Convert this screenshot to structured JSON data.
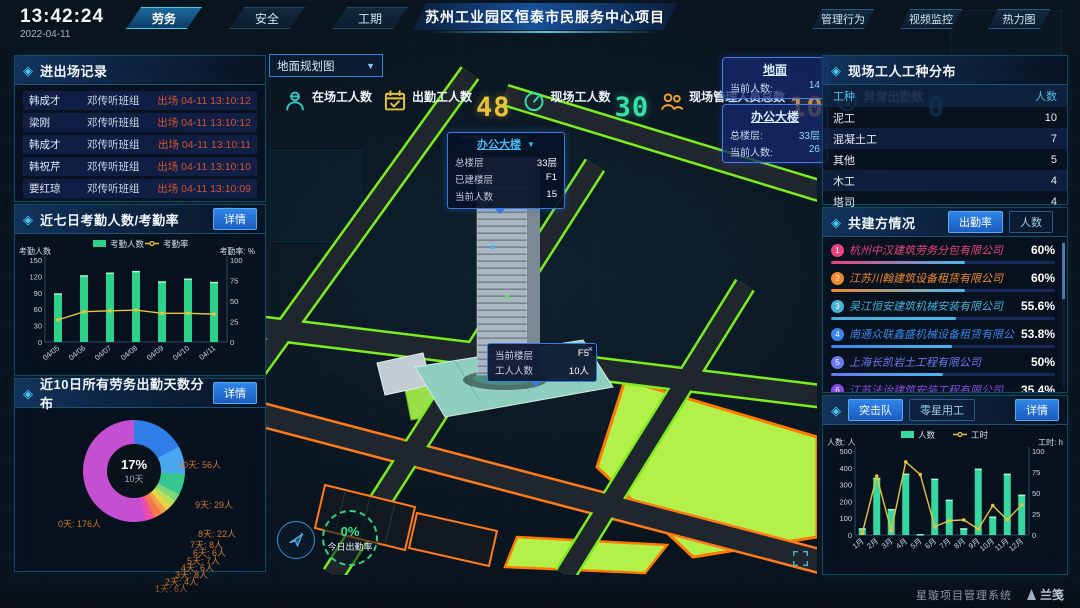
{
  "topbar": {
    "time": "13:42:24",
    "date": "2022-04-11",
    "tabs_left": [
      "劳务",
      "安全",
      "工期"
    ],
    "active_tab_left": "劳务",
    "title": "苏州工业园区恒泰市民服务中心项目",
    "tabs_right": [
      "管理行为",
      "视频监控",
      "热力图"
    ]
  },
  "entry_exit": {
    "title": "进出场记录",
    "more_label": "更多>>",
    "rows": [
      {
        "name": "韩成才",
        "group": "邓传听班组",
        "event": "出场 04-11 13:10:12"
      },
      {
        "name": "梁刚",
        "group": "邓传听班组",
        "event": "出场 04-11 13:10:12"
      },
      {
        "name": "韩成才",
        "group": "邓传听班组",
        "event": "出场 04-11 13:10:11"
      },
      {
        "name": "韩祝芹",
        "group": "邓传听班组",
        "event": "出场 04-11 13:10:10"
      },
      {
        "name": "要红琼",
        "group": "邓传听班组",
        "event": "出场 04-11 13:10:09"
      }
    ]
  },
  "attendance_panel": {
    "title": "近七日考勤人数/考勤率",
    "detail_label": "详情"
  },
  "distribution_panel": {
    "title": "近10日所有劳务出勤天数分布",
    "detail_label": "详情"
  },
  "center": {
    "map_select": "地面规划图",
    "stats": [
      {
        "label": "在场工人数",
        "value": "",
        "color": "#2ec8c0",
        "icon": "worker-icon"
      },
      {
        "label": "出勤工人数",
        "value": "48",
        "color": "#e8c33a",
        "icon": "calendar-check-icon"
      },
      {
        "label": "现场工人数",
        "value": "30",
        "color": "#35e0a8",
        "icon": "gauge-icon"
      },
      {
        "label": "现场管理人员总数",
        "value": "10",
        "color": "#f0a030",
        "icon": "people-icon"
      },
      {
        "label": "异常出勤数",
        "value": "0",
        "color": "#35a0f0",
        "icon": "pulse-icon"
      }
    ],
    "building_tooltip": {
      "title": "办公大楼",
      "rows": [
        [
          "总楼层",
          "33层"
        ],
        [
          "已建楼层",
          "F1"
        ],
        [
          "当前人数",
          "15"
        ]
      ]
    },
    "floor_tooltip": {
      "close": "×",
      "rows": [
        [
          "当前楼层",
          "F5"
        ],
        [
          "工人人数",
          "10人"
        ]
      ]
    },
    "ground_box": {
      "title": "地面",
      "rows": [
        [
          "当前人数:",
          "14"
        ]
      ]
    },
    "office_box": {
      "title": "办公大楼",
      "rows": [
        [
          "总楼层:",
          "33层"
        ],
        [
          "当前人数:",
          "26"
        ]
      ]
    },
    "gauge": {
      "value": "0%",
      "label": "今日出勤率"
    }
  },
  "trade_table": {
    "title": "现场工人工种分布",
    "headers": [
      "工种",
      "人数"
    ],
    "rows": [
      [
        "泥工",
        "10"
      ],
      [
        "混凝土工",
        "7"
      ],
      [
        "其他",
        "5"
      ],
      [
        "木工",
        "4"
      ],
      [
        "塔司",
        "4"
      ]
    ]
  },
  "partners": {
    "title": "共建方情况",
    "tabs": [
      "出勤率",
      "人数"
    ],
    "active_tab": "出勤率",
    "items": [
      {
        "rank": "1",
        "name": "杭州中汉建筑劳务分包有限公司",
        "value": "60%",
        "pct": 60,
        "color": "#e8437e"
      },
      {
        "rank": "2",
        "name": "江苏川翰建筑设备租赁有限公司",
        "value": "60%",
        "pct": 60,
        "color": "#f0882e"
      },
      {
        "rank": "3",
        "name": "吴江恒安建筑机械安装有限公司",
        "value": "55.6%",
        "pct": 55.6,
        "color": "#4ab0d8"
      },
      {
        "rank": "4",
        "name": "南通众联鑫盛机械设备租赁有限公司",
        "value": "53.8%",
        "pct": 53.8,
        "color": "#3a86e8"
      },
      {
        "rank": "5",
        "name": "上海长凯岩土工程有限公司",
        "value": "50%",
        "pct": 50,
        "color": "#6a78f0"
      },
      {
        "rank": "6",
        "name": "江苏法诒建筑安装工程有限公司",
        "value": "35.4%",
        "pct": 35.4,
        "color": "#8a4ae0"
      }
    ]
  },
  "squad_panel": {
    "tabs": [
      "突击队",
      "零星用工"
    ],
    "active_tab": "突击队",
    "detail_label": "详情"
  },
  "footer": {
    "system_name": "星璇项目管理系统",
    "brand": "兰笺"
  },
  "chart_data": [
    {
      "id": "attendance",
      "type": "bar+line",
      "title": "近七日考勤人数/考勤率",
      "categories": [
        "04/05",
        "04/06",
        "04/07",
        "04/08",
        "04/09",
        "04/10",
        "04/11"
      ],
      "series": [
        {
          "name": "考勤人数",
          "type": "bar",
          "color": "#2ed18a",
          "values": [
            89,
            122,
            127,
            130,
            111,
            116,
            110
          ]
        },
        {
          "name": "考勤率",
          "type": "line",
          "color": "#e8c33a",
          "axis": "right",
          "values": [
            27,
            37,
            38,
            39,
            35,
            35,
            34
          ]
        }
      ],
      "left_axis": {
        "label": "考勤人数",
        "min": 0,
        "max": 150,
        "ticks": [
          0,
          30,
          60,
          90,
          120,
          150
        ]
      },
      "right_axis": {
        "label": "考勤率: %",
        "min": 0,
        "max": 100,
        "ticks": [
          0,
          25,
          50,
          75,
          100
        ]
      },
      "legend_position": "top",
      "grid": false
    },
    {
      "id": "distribution",
      "type": "donut",
      "title": "近10日所有劳务出勤天数分布",
      "center": {
        "percent": "17%",
        "label": "10天"
      },
      "slices": [
        {
          "label": "10天",
          "count": 56,
          "text": "10天: 56人",
          "color": "#2f7ee8"
        },
        {
          "label": "9天",
          "count": 29,
          "text": "9天: 29人",
          "color": "#49a6f0"
        },
        {
          "label": "8天",
          "count": 22,
          "text": "8天: 22人",
          "color": "#35c78f"
        },
        {
          "label": "7天",
          "count": 8,
          "text": "7天: 8人",
          "color": "#7ed87a"
        },
        {
          "label": "6天",
          "count": 6,
          "text": "6天: 6人",
          "color": "#b9e05a"
        },
        {
          "label": "5天",
          "count": 7,
          "text": "5天: 7人",
          "color": "#e8d44a"
        },
        {
          "label": "4天",
          "count": 6,
          "text": "4天: 6人",
          "color": "#f0a04a"
        },
        {
          "label": "3天",
          "count": 8,
          "text": "3天: 8人",
          "color": "#f07a4a"
        },
        {
          "label": "2天",
          "count": 4,
          "text": "2天: 4人",
          "color": "#f05a8a"
        },
        {
          "label": "1天",
          "count": 6,
          "text": "1天: 6人",
          "color": "#e84ab8"
        },
        {
          "label": "0天",
          "count": 176,
          "text": "0天: 176人",
          "color": "#c44fd0"
        }
      ]
    },
    {
      "id": "squad",
      "type": "bar+line",
      "title": "突击队",
      "categories": [
        "1月",
        "2月",
        "3月",
        "4月",
        "5月",
        "6月",
        "7月",
        "8月",
        "9月",
        "10月",
        "11月",
        "12月"
      ],
      "series": [
        {
          "name": "人数",
          "type": "bar",
          "color": "#35d9a0",
          "values": [
            40,
            340,
            155,
            365,
            5,
            335,
            210,
            40,
            395,
            110,
            365,
            240
          ]
        },
        {
          "name": "工时",
          "type": "line",
          "color": "#e8c33a",
          "axis": "right",
          "values": [
            2,
            70,
            5,
            87,
            72,
            10,
            17,
            18,
            7,
            35,
            18,
            36
          ]
        }
      ],
      "left_axis": {
        "label": "人数: 人",
        "min": 0,
        "max": 500,
        "ticks": [
          0,
          100,
          200,
          300,
          400,
          500
        ]
      },
      "right_axis": {
        "label": "工时: h",
        "min": 0,
        "max": 100,
        "ticks": [
          0,
          25,
          50,
          75,
          100
        ]
      },
      "legend_position": "top",
      "grid": false
    }
  ]
}
